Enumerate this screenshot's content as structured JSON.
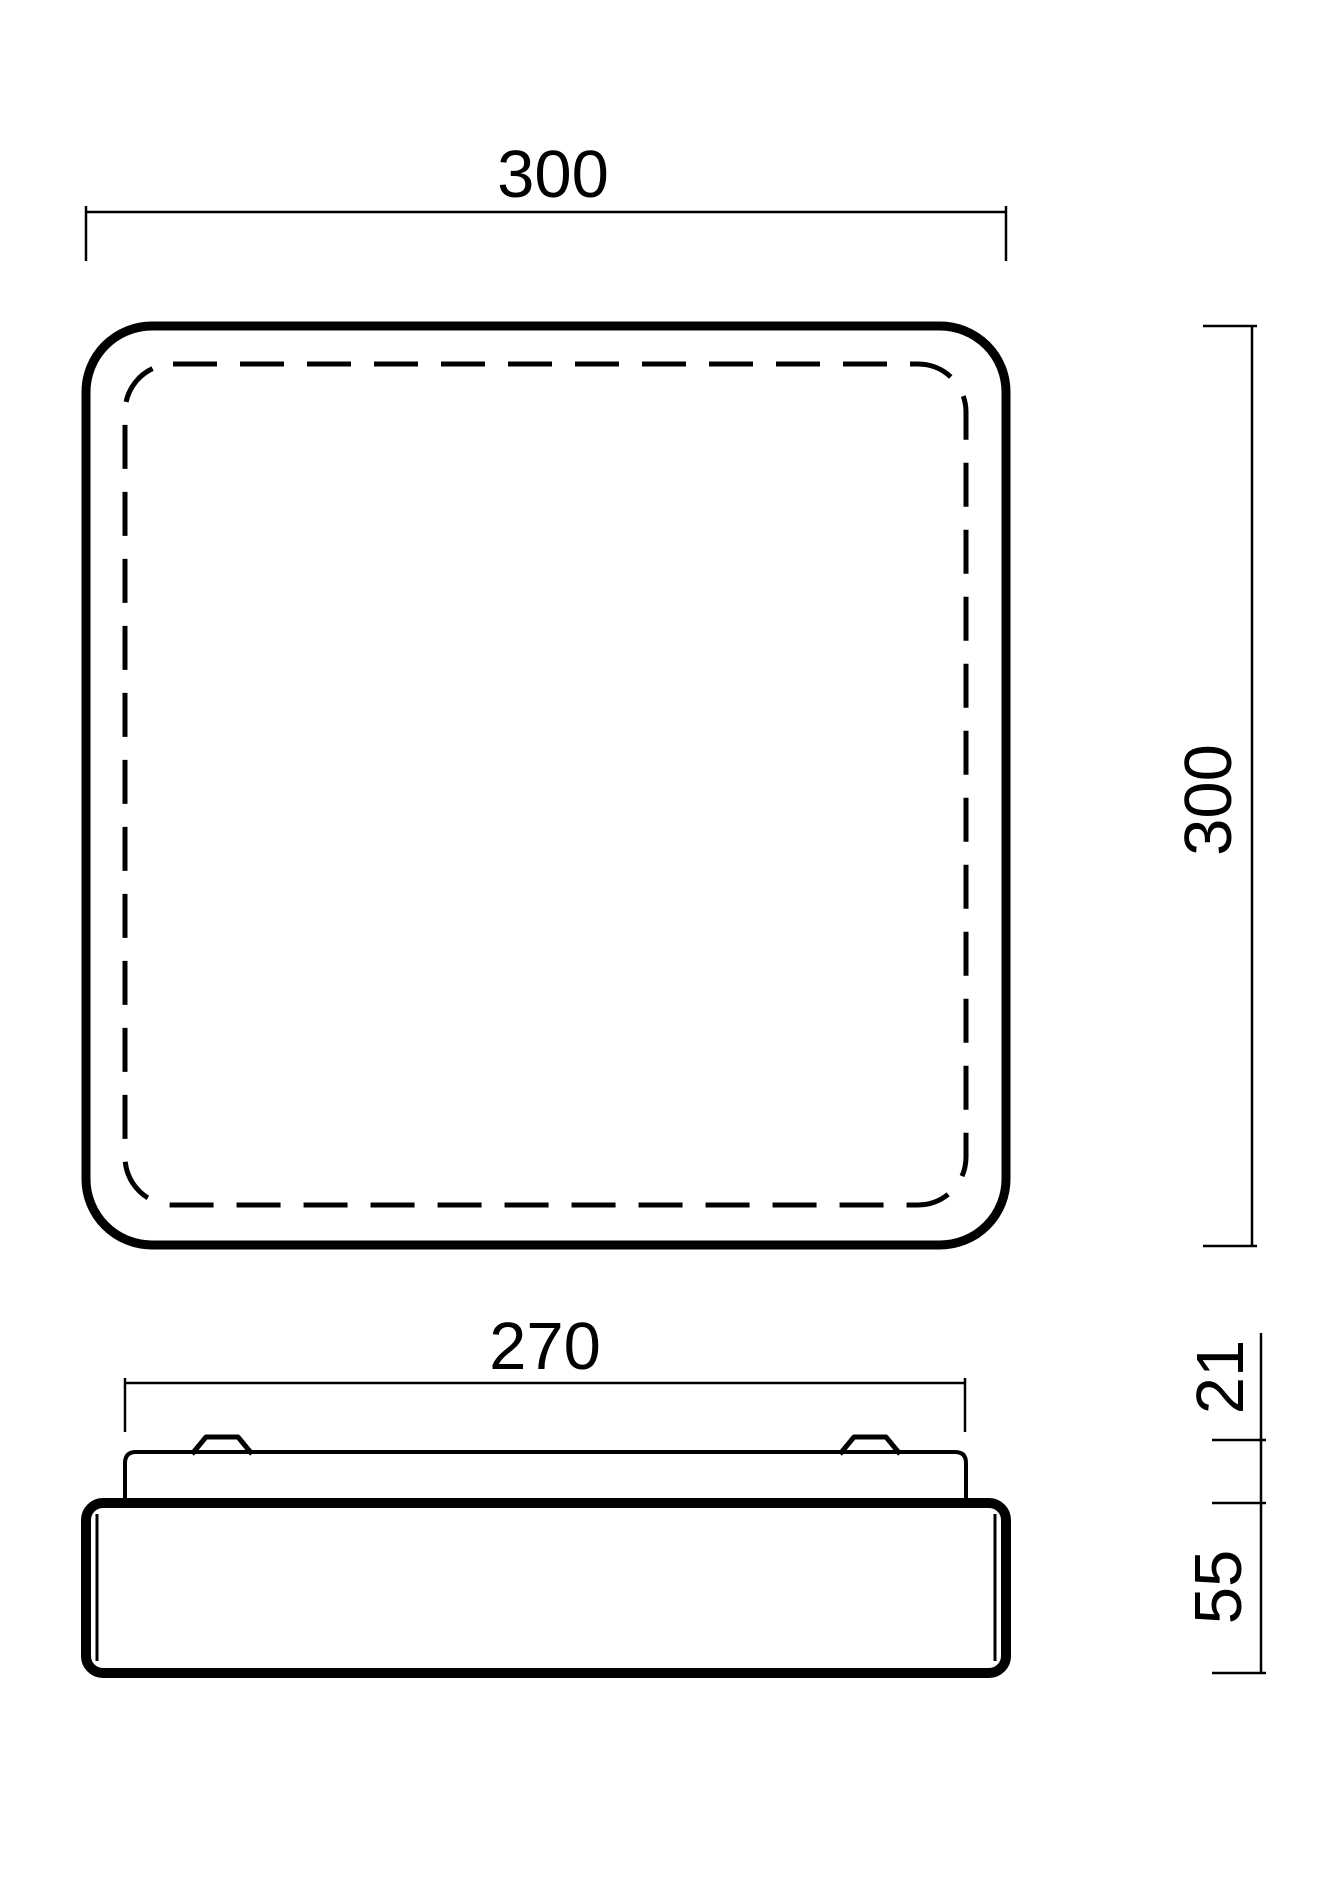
{
  "page": {
    "background": "#ffffff"
  },
  "drawing": {
    "type": "technical-dimension-drawing",
    "line_color": "#000000",
    "views": {
      "top_view": {
        "width_label": "300",
        "height_label": "300"
      },
      "side_view": {
        "width_label": "270",
        "clip_offset_label": "21",
        "base_height_label": "55"
      }
    }
  }
}
